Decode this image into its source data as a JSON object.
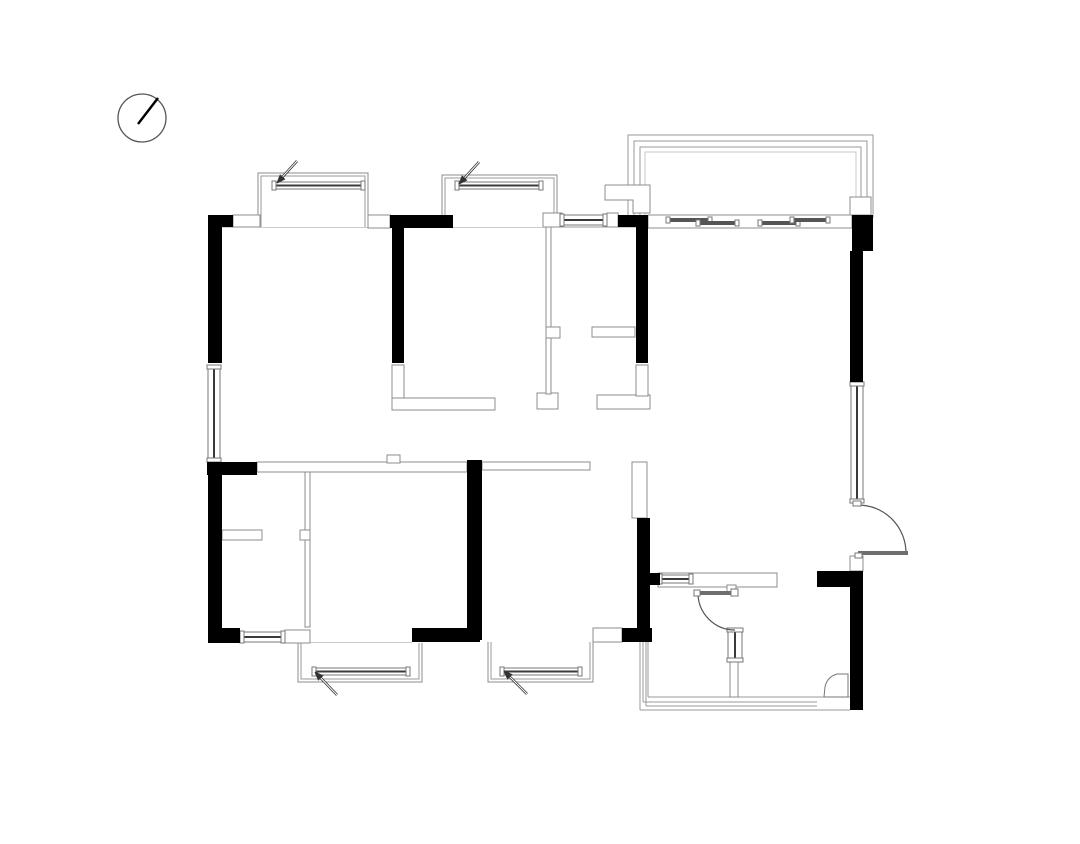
{
  "meta": {
    "title": "Residential apartment floor plan drawing",
    "canvas": {
      "width": 1080,
      "height": 844
    },
    "background": "#ffffff"
  },
  "colors": {
    "wall_black": "#000000",
    "outline_gray": "#8c8c8c",
    "line_gray": "#999999",
    "light_gray": "#c9c9c9",
    "window_frame": "#777777",
    "glazing_dark": "#3a3a3a",
    "door_leaf": "#6e6e6e",
    "arc_gray": "#555555",
    "arrow_dark": "#333333"
  },
  "north_arrow": {
    "cx": 142,
    "cy": 118,
    "r": 24,
    "needle": [
      [
        138,
        124
      ],
      [
        158,
        98
      ]
    ]
  },
  "plan": {
    "base_lines": [
      {
        "pts": [
          [
            208,
            227
          ],
          [
            873,
            227
          ]
        ],
        "w": 1
      },
      {
        "pts": [
          [
            300,
            643
          ],
          [
            412,
            643
          ]
        ],
        "w": 1
      },
      {
        "pts": [
          [
            648,
            697
          ],
          [
            850,
            697
          ]
        ],
        "w": 1
      },
      {
        "pts": [
          [
            643,
            702
          ],
          [
            817,
            702
          ]
        ],
        "w": 1
      },
      {
        "pts": [
          [
            646,
            706
          ],
          [
            817,
            706
          ]
        ],
        "w": 1
      },
      {
        "pts": [
          [
            640,
            710
          ],
          [
            850,
            710
          ]
        ],
        "w": 1
      },
      {
        "pts": [
          [
            640,
            642
          ],
          [
            640,
            710
          ]
        ],
        "w": 1
      },
      {
        "pts": [
          [
            643,
            642
          ],
          [
            643,
            702
          ]
        ],
        "w": 1
      },
      {
        "pts": [
          [
            646,
            642
          ],
          [
            646,
            706
          ]
        ],
        "w": 1
      },
      {
        "pts": [
          [
            648,
            642
          ],
          [
            648,
            697
          ]
        ],
        "w": 1
      }
    ],
    "balcony": {
      "lines": [
        {
          "pts": [
            [
              628,
              218
            ],
            [
              628,
              135
            ],
            [
              873,
              135
            ],
            [
              873,
              218
            ]
          ],
          "light": false
        },
        {
          "pts": [
            [
              634,
              218
            ],
            [
              634,
              141
            ],
            [
              867,
              141
            ],
            [
              867,
              218
            ]
          ],
          "light": false
        },
        {
          "pts": [
            [
              640,
              218
            ],
            [
              640,
              147
            ],
            [
              861,
              147
            ],
            [
              861,
              218
            ]
          ],
          "light": false
        },
        {
          "pts": [
            [
              645,
              218
            ],
            [
              645,
              152
            ],
            [
              856,
              152
            ],
            [
              856,
              218
            ]
          ],
          "light": true
        }
      ],
      "step_piece": [
        [
          605,
          185
        ],
        [
          650,
          185
        ],
        [
          650,
          213
        ],
        [
          633,
          213
        ],
        [
          633,
          200
        ],
        [
          605,
          200
        ]
      ]
    },
    "bays": [
      {
        "outer": [
          [
            258,
            227
          ],
          [
            258,
            173
          ],
          [
            368,
            173
          ],
          [
            368,
            227
          ]
        ],
        "inner": [
          [
            261,
            227
          ],
          [
            261,
            176
          ],
          [
            365,
            176
          ],
          [
            365,
            227
          ]
        ]
      },
      {
        "outer": [
          [
            442,
            227
          ],
          [
            442,
            175
          ],
          [
            557,
            175
          ],
          [
            557,
            227
          ]
        ],
        "inner": [
          [
            445,
            227
          ],
          [
            445,
            178
          ],
          [
            554,
            178
          ],
          [
            554,
            227
          ]
        ]
      },
      {
        "outer": [
          [
            298,
            643
          ],
          [
            298,
            682
          ],
          [
            422,
            682
          ],
          [
            422,
            643
          ]
        ],
        "inner": [
          [
            301,
            643
          ],
          [
            301,
            679
          ],
          [
            419,
            679
          ],
          [
            419,
            643
          ]
        ]
      },
      {
        "outer": [
          [
            488,
            642
          ],
          [
            488,
            682
          ],
          [
            593,
            682
          ],
          [
            593,
            642
          ]
        ],
        "inner": [
          [
            491,
            642
          ],
          [
            491,
            679
          ],
          [
            590,
            679
          ],
          [
            590,
            642
          ]
        ]
      }
    ],
    "white_walls": [
      [
        233,
        215,
        27,
        12
      ],
      [
        368,
        215,
        22,
        13
      ],
      [
        543,
        213,
        19,
        14
      ],
      [
        607,
        213,
        11,
        14
      ],
      [
        648,
        215,
        204,
        13
      ],
      [
        850,
        197,
        21,
        18
      ],
      [
        392,
        365,
        12,
        33
      ],
      [
        392,
        398,
        103,
        12
      ],
      [
        537,
        393,
        21,
        16
      ],
      [
        546,
        227,
        5,
        167
      ],
      [
        546,
        327,
        14,
        11
      ],
      [
        592,
        327,
        43,
        10
      ],
      [
        597,
        395,
        53,
        14
      ],
      [
        636,
        365,
        12,
        31
      ],
      [
        257,
        462,
        210,
        10
      ],
      [
        387,
        455,
        13,
        8
      ],
      [
        482,
        462,
        108,
        8
      ],
      [
        632,
        462,
        15,
        56
      ],
      [
        305,
        472,
        5,
        155
      ],
      [
        222,
        530,
        40,
        10
      ],
      [
        300,
        530,
        10,
        10
      ],
      [
        285,
        630,
        25,
        13
      ],
      [
        593,
        628,
        29,
        14
      ],
      [
        658,
        573,
        119,
        14
      ],
      [
        727,
        585,
        9,
        8
      ],
      [
        730,
        662,
        8,
        35
      ],
      [
        850,
        556,
        13,
        15
      ]
    ],
    "windows": [
      {
        "r": [
          272,
          182,
          93,
          7
        ],
        "orient": "h"
      },
      {
        "r": [
          455,
          182,
          88,
          7
        ],
        "orient": "h"
      },
      {
        "r": [
          560,
          215,
          47,
          10
        ],
        "orient": "h"
      },
      {
        "r": [
          208,
          365,
          12,
          97
        ],
        "orient": "v"
      },
      {
        "r": [
          240,
          632,
          45,
          10
        ],
        "orient": "h"
      },
      {
        "r": [
          312,
          668,
          98,
          7
        ],
        "orient": "h"
      },
      {
        "r": [
          500,
          668,
          82,
          7
        ],
        "orient": "h"
      },
      {
        "r": [
          851,
          382,
          12,
          121
        ],
        "orient": "v"
      },
      {
        "r": [
          658,
          575,
          35,
          8
        ],
        "orient": "h"
      },
      {
        "r": [
          728,
          628,
          14,
          34
        ],
        "orient": "v"
      }
    ],
    "sliding_panels": [
      [
        668,
        218,
        42,
        4
      ],
      [
        698,
        221,
        39,
        4
      ],
      [
        760,
        221,
        38,
        4
      ],
      [
        792,
        218,
        36,
        4
      ]
    ],
    "black_walls": [
      [
        208,
        215,
        25,
        12
      ],
      [
        208,
        215,
        14,
        148
      ],
      [
        390,
        215,
        63,
        13
      ],
      [
        392,
        217,
        12,
        146
      ],
      [
        618,
        215,
        30,
        12
      ],
      [
        636,
        215,
        12,
        148
      ],
      [
        852,
        215,
        21,
        36
      ],
      [
        850,
        251,
        13,
        131
      ],
      [
        207,
        462,
        50,
        13
      ],
      [
        208,
        462,
        14,
        181
      ],
      [
        208,
        628,
        32,
        15
      ],
      [
        412,
        628,
        68,
        14
      ],
      [
        467,
        460,
        15,
        180
      ],
      [
        622,
        628,
        30,
        14
      ],
      [
        637,
        518,
        13,
        122
      ],
      [
        650,
        573,
        10,
        12
      ],
      [
        817,
        571,
        46,
        16
      ],
      [
        850,
        587,
        13,
        123
      ]
    ],
    "doors": [
      {
        "name": "entry-door",
        "leaf": [
          858,
          551,
          50,
          4
        ],
        "arc": "M 858 505 A 48 48 0 0 1 906 553",
        "caps": [
          [
            853,
            501,
            8,
            5
          ],
          [
            855,
            553,
            7,
            5
          ]
        ]
      },
      {
        "name": "bathroom-door",
        "leaf": [
          698,
          591,
          37,
          4
        ],
        "arc": "M 698 593 A 37 37 0 0 0 735 630",
        "caps": [
          [
            694,
            590,
            6,
            6
          ],
          [
            731,
            589,
            7,
            7
          ]
        ]
      }
    ],
    "misc_paths": [
      {
        "d": "M 848 674 L 837 674 Q 827 677 825 687 L 824 697 L 848 697 Z",
        "fill": "#ffffff"
      }
    ],
    "leader_arrows": [
      {
        "tail": [
          297,
          161
        ],
        "head": [
          277,
          183
        ]
      },
      {
        "tail": [
          479,
          162
        ],
        "head": [
          459,
          184
        ]
      },
      {
        "tail": [
          337,
          695
        ],
        "head": [
          315,
          672
        ]
      },
      {
        "tail": [
          527,
          694
        ],
        "head": [
          504,
          671
        ]
      }
    ]
  }
}
